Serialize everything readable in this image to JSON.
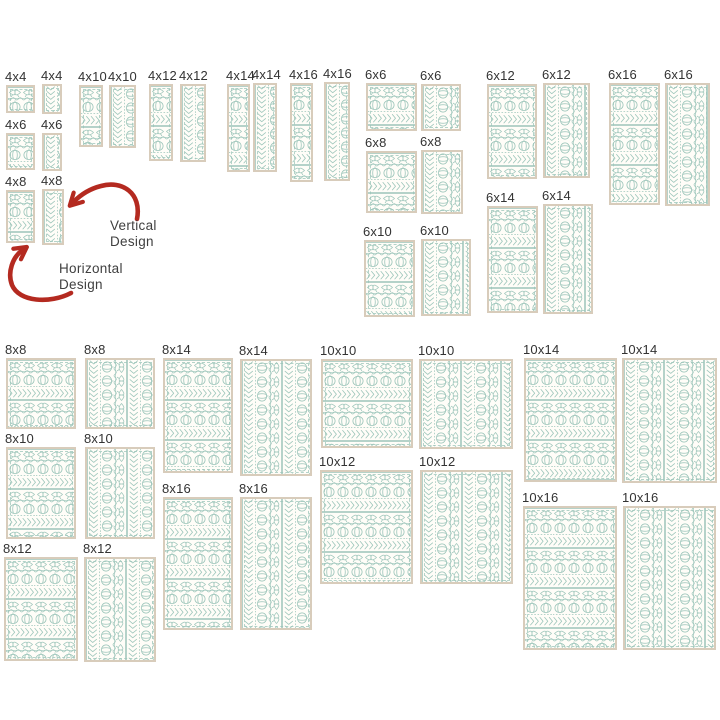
{
  "palette": {
    "stitch": "#9cc5ba",
    "frame": "#d8ccbb",
    "swatch_bg": "#fffdf8",
    "label_color": "#333333",
    "arrow_color": "#b42a20",
    "note_color": "#3f3f3f",
    "page_bg": "#ffffff"
  },
  "annotations": {
    "vertical": {
      "lines": [
        "Vertical",
        "Design"
      ]
    },
    "horizontal": {
      "lines": [
        "Horizontal",
        "Design"
      ]
    }
  },
  "catalog": {
    "description": "Quilt border embroidery design size chart; each size shown as a horizontal-design and a vertical-design swatch",
    "sizes": [
      "4x4",
      "4x6",
      "4x8",
      "4x10",
      "4x12",
      "4x14",
      "4x16",
      "6x6",
      "6x8",
      "6x10",
      "6x12",
      "6x14",
      "6x16",
      "8x8",
      "8x10",
      "8x12",
      "8x14",
      "8x16",
      "10x10",
      "10x12",
      "10x14",
      "10x16"
    ],
    "items": [
      {
        "label": "4x4",
        "orientation": "horizontal",
        "x": 6,
        "y": 85,
        "w": 29,
        "h": 28
      },
      {
        "label": "4x4",
        "orientation": "vertical",
        "x": 42,
        "y": 84,
        "w": 20,
        "h": 30
      },
      {
        "label": "4x6",
        "orientation": "horizontal",
        "x": 6,
        "y": 133,
        "w": 29,
        "h": 37
      },
      {
        "label": "4x6",
        "orientation": "vertical",
        "x": 42,
        "y": 133,
        "w": 20,
        "h": 38
      },
      {
        "label": "4x8",
        "orientation": "horizontal",
        "x": 6,
        "y": 190,
        "w": 29,
        "h": 53
      },
      {
        "label": "4x8",
        "orientation": "vertical",
        "x": 42,
        "y": 189,
        "w": 22,
        "h": 56
      },
      {
        "label": "4x10",
        "orientation": "horizontal",
        "x": 79,
        "y": 85,
        "w": 24,
        "h": 62
      },
      {
        "label": "4x10",
        "orientation": "vertical",
        "x": 109,
        "y": 85,
        "w": 27,
        "h": 63
      },
      {
        "label": "4x12",
        "orientation": "horizontal",
        "x": 149,
        "y": 84,
        "w": 24,
        "h": 77
      },
      {
        "label": "4x12",
        "orientation": "vertical",
        "x": 180,
        "y": 84,
        "w": 26,
        "h": 78
      },
      {
        "label": "4x14",
        "orientation": "horizontal",
        "x": 227,
        "y": 84,
        "w": 23,
        "h": 88
      },
      {
        "label": "4x14",
        "orientation": "vertical",
        "x": 253,
        "y": 83,
        "w": 24,
        "h": 89
      },
      {
        "label": "4x16",
        "orientation": "horizontal",
        "x": 290,
        "y": 83,
        "w": 23,
        "h": 99
      },
      {
        "label": "4x16",
        "orientation": "vertical",
        "x": 324,
        "y": 82,
        "w": 26,
        "h": 99
      },
      {
        "label": "6x6",
        "orientation": "horizontal",
        "x": 366,
        "y": 83,
        "w": 51,
        "h": 48
      },
      {
        "label": "6x6",
        "orientation": "vertical",
        "x": 421,
        "y": 84,
        "w": 40,
        "h": 47
      },
      {
        "label": "6x8",
        "orientation": "horizontal",
        "x": 366,
        "y": 151,
        "w": 51,
        "h": 62
      },
      {
        "label": "6x8",
        "orientation": "vertical",
        "x": 421,
        "y": 150,
        "w": 42,
        "h": 64
      },
      {
        "label": "6x10",
        "orientation": "horizontal",
        "x": 364,
        "y": 240,
        "w": 51,
        "h": 77
      },
      {
        "label": "6x10",
        "orientation": "vertical",
        "x": 421,
        "y": 239,
        "w": 50,
        "h": 77
      },
      {
        "label": "6x12",
        "orientation": "horizontal",
        "x": 487,
        "y": 84,
        "w": 50,
        "h": 95
      },
      {
        "label": "6x12",
        "orientation": "vertical",
        "x": 543,
        "y": 83,
        "w": 47,
        "h": 95
      },
      {
        "label": "6x14",
        "orientation": "horizontal",
        "x": 487,
        "y": 206,
        "w": 51,
        "h": 107
      },
      {
        "label": "6x14",
        "orientation": "vertical",
        "x": 543,
        "y": 204,
        "w": 50,
        "h": 110
      },
      {
        "label": "6x16",
        "orientation": "horizontal",
        "x": 609,
        "y": 83,
        "w": 51,
        "h": 122
      },
      {
        "label": "6x16",
        "orientation": "vertical",
        "x": 665,
        "y": 83,
        "w": 45,
        "h": 123
      },
      {
        "label": "8x8",
        "orientation": "horizontal",
        "x": 6,
        "y": 358,
        "w": 70,
        "h": 71
      },
      {
        "label": "8x8",
        "orientation": "vertical",
        "x": 85,
        "y": 358,
        "w": 70,
        "h": 71
      },
      {
        "label": "8x10",
        "orientation": "horizontal",
        "x": 6,
        "y": 447,
        "w": 70,
        "h": 92
      },
      {
        "label": "8x10",
        "orientation": "vertical",
        "x": 85,
        "y": 447,
        "w": 70,
        "h": 92
      },
      {
        "label": "8x12",
        "orientation": "horizontal",
        "x": 4,
        "y": 557,
        "w": 74,
        "h": 104
      },
      {
        "label": "8x12",
        "orientation": "vertical",
        "x": 84,
        "y": 557,
        "w": 72,
        "h": 105
      },
      {
        "label": "8x14",
        "orientation": "horizontal",
        "x": 163,
        "y": 358,
        "w": 70,
        "h": 115
      },
      {
        "label": "8x14",
        "orientation": "vertical",
        "x": 240,
        "y": 359,
        "w": 72,
        "h": 117
      },
      {
        "label": "8x16",
        "orientation": "horizontal",
        "x": 163,
        "y": 497,
        "w": 70,
        "h": 133
      },
      {
        "label": "8x16",
        "orientation": "vertical",
        "x": 240,
        "y": 497,
        "w": 72,
        "h": 133
      },
      {
        "label": "10x10",
        "orientation": "horizontal",
        "x": 321,
        "y": 359,
        "w": 92,
        "h": 89
      },
      {
        "label": "10x10",
        "orientation": "vertical",
        "x": 419,
        "y": 359,
        "w": 94,
        "h": 90
      },
      {
        "label": "10x12",
        "orientation": "horizontal",
        "x": 320,
        "y": 470,
        "w": 93,
        "h": 114
      },
      {
        "label": "10x12",
        "orientation": "vertical",
        "x": 420,
        "y": 470,
        "w": 93,
        "h": 114
      },
      {
        "label": "10x14",
        "orientation": "horizontal",
        "x": 524,
        "y": 358,
        "w": 93,
        "h": 124
      },
      {
        "label": "10x14",
        "orientation": "vertical",
        "x": 622,
        "y": 358,
        "w": 95,
        "h": 125
      },
      {
        "label": "10x16",
        "orientation": "horizontal",
        "x": 523,
        "y": 506,
        "w": 94,
        "h": 144
      },
      {
        "label": "10x16",
        "orientation": "vertical",
        "x": 623,
        "y": 506,
        "w": 93,
        "h": 144
      }
    ]
  }
}
